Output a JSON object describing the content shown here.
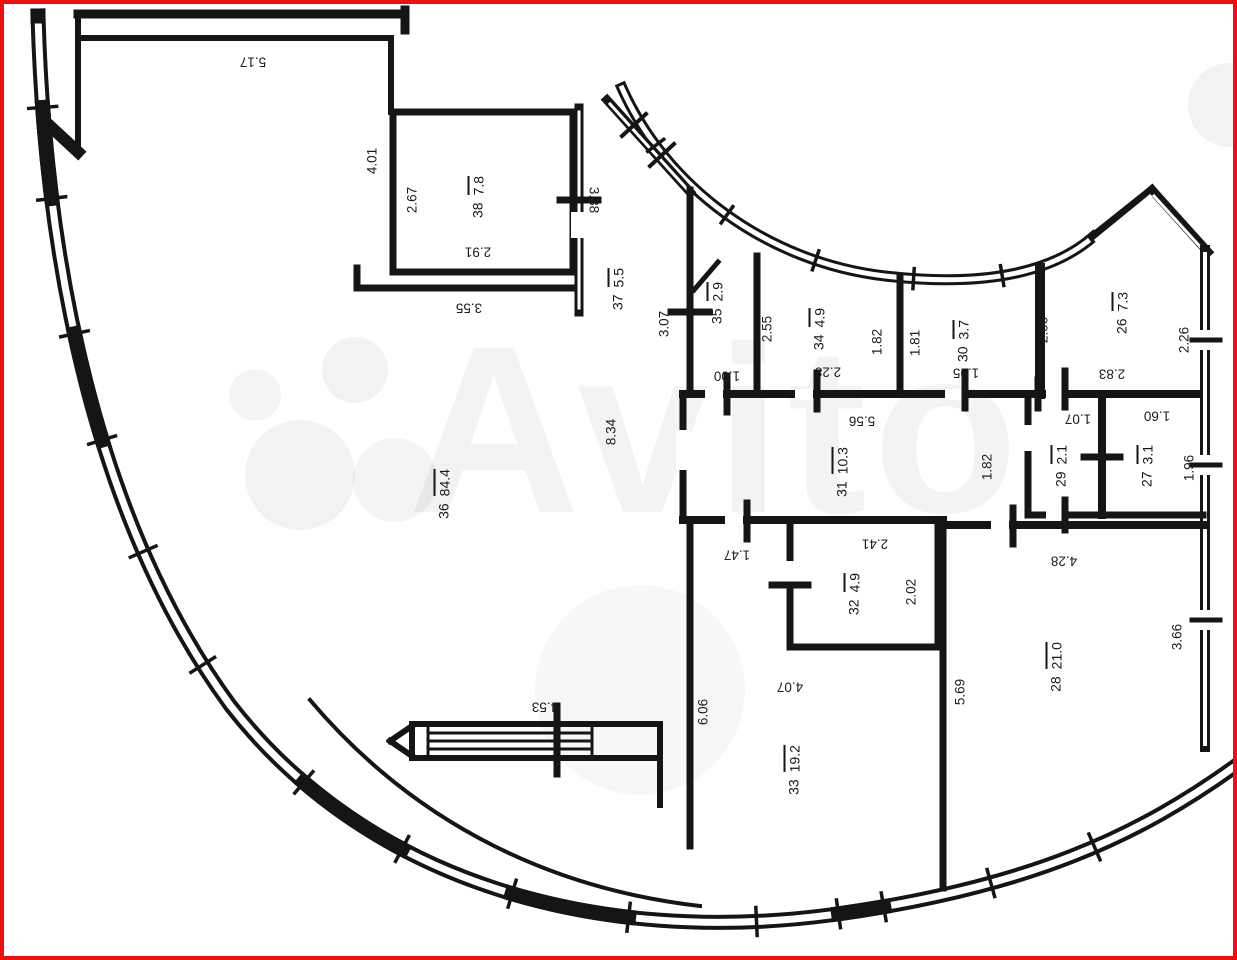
{
  "meta": {
    "description": "Floor plan drawing of a circular apartment building segment",
    "colors": {
      "wall": "#151515",
      "background": "#ffffff",
      "frame_red": "#ee1010",
      "label_text": "#1c1c1c",
      "watermark_gray": "#000000"
    }
  },
  "watermark": {
    "brand": "Avito"
  },
  "plan": {
    "rooms": [
      {
        "number": "38",
        "area": "7.8",
        "x": 477,
        "y": 197,
        "rot": -90
      },
      {
        "number": "37",
        "area": "5.5",
        "x": 617,
        "y": 289,
        "rot": -90
      },
      {
        "number": "35",
        "area": "2.9",
        "x": 716,
        "y": 303,
        "rot": -90
      },
      {
        "number": "34",
        "area": "4.9",
        "x": 818,
        "y": 329,
        "rot": -90
      },
      {
        "number": "30",
        "area": "3.7",
        "x": 962,
        "y": 341,
        "rot": -90
      },
      {
        "number": "26",
        "area": "7.3",
        "x": 1121,
        "y": 313,
        "rot": -90
      },
      {
        "number": "36",
        "area": "84.4",
        "x": 443,
        "y": 494,
        "rot": -90
      },
      {
        "number": "31",
        "area": "10.3",
        "x": 841,
        "y": 472,
        "rot": -90
      },
      {
        "number": "29",
        "area": "2.1",
        "x": 1060,
        "y": 466,
        "rot": -90
      },
      {
        "number": "27",
        "area": "3.1",
        "x": 1146,
        "y": 466,
        "rot": -90
      },
      {
        "number": "32",
        "area": "4.9",
        "x": 853,
        "y": 594,
        "rot": -90
      },
      {
        "number": "28",
        "area": "21.0",
        "x": 1055,
        "y": 667,
        "rot": -90
      },
      {
        "number": "33",
        "area": "19.2",
        "x": 793,
        "y": 770,
        "rot": -90
      }
    ],
    "dimensions": [
      {
        "value": "5.17",
        "x": 253,
        "y": 62,
        "rot": 180
      },
      {
        "value": "4.01",
        "x": 372,
        "y": 161,
        "rot": -90
      },
      {
        "value": "2.67",
        "x": 412,
        "y": 200,
        "rot": -90
      },
      {
        "value": "3.88",
        "x": 594,
        "y": 200,
        "rot": 90
      },
      {
        "value": "2.91",
        "x": 478,
        "y": 252,
        "rot": 180
      },
      {
        "value": "3.55",
        "x": 469,
        "y": 308,
        "rot": 180
      },
      {
        "value": "3.07",
        "x": 664,
        "y": 324,
        "rot": -90
      },
      {
        "value": "1.00",
        "x": 727,
        "y": 376,
        "rot": 180
      },
      {
        "value": "2.55",
        "x": 767,
        "y": 329,
        "rot": -90
      },
      {
        "value": "2.28",
        "x": 828,
        "y": 372,
        "rot": 180
      },
      {
        "value": "1.82",
        "x": 877,
        "y": 342,
        "rot": -90
      },
      {
        "value": "1.81",
        "x": 915,
        "y": 343,
        "rot": -90
      },
      {
        "value": "1.95",
        "x": 966,
        "y": 373,
        "rot": 180
      },
      {
        "value": "2.06",
        "x": 1043,
        "y": 330,
        "rot": -90
      },
      {
        "value": "2.26",
        "x": 1184,
        "y": 340,
        "rot": -90
      },
      {
        "value": "2.83",
        "x": 1112,
        "y": 374,
        "rot": 180
      },
      {
        "value": "8.34",
        "x": 611,
        "y": 432,
        "rot": -90
      },
      {
        "value": "5.56",
        "x": 862,
        "y": 421,
        "rot": 180
      },
      {
        "value": "1.82",
        "x": 987,
        "y": 467,
        "rot": -90
      },
      {
        "value": "1.07",
        "x": 1078,
        "y": 419,
        "rot": 180
      },
      {
        "value": "1.60",
        "x": 1157,
        "y": 416,
        "rot": 180
      },
      {
        "value": "1.96",
        "x": 1189,
        "y": 468,
        "rot": -90
      },
      {
        "value": "1.47",
        "x": 737,
        "y": 555,
        "rot": 180
      },
      {
        "value": "2.41",
        "x": 875,
        "y": 544,
        "rot": 180
      },
      {
        "value": "2.02",
        "x": 911,
        "y": 592,
        "rot": -90
      },
      {
        "value": "4.28",
        "x": 1064,
        "y": 561,
        "rot": 180
      },
      {
        "value": "3.66",
        "x": 1177,
        "y": 637,
        "rot": -90
      },
      {
        "value": "5.69",
        "x": 960,
        "y": 692,
        "rot": -90
      },
      {
        "value": "6.06",
        "x": 703,
        "y": 712,
        "rot": -90
      },
      {
        "value": "4.07",
        "x": 790,
        "y": 687,
        "rot": 180
      },
      {
        "value": "4.53",
        "x": 545,
        "y": 707,
        "rot": 180
      }
    ]
  }
}
